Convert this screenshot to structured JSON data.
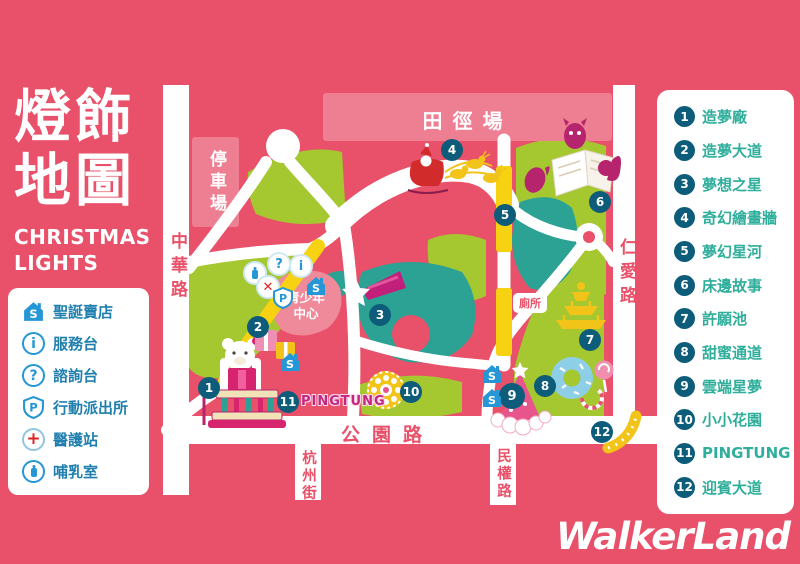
{
  "header": {
    "title_line1": "燈飾",
    "title_line2": "地圖",
    "subtitle_line1": "CHRISTMAS",
    "subtitle_line2": "LIGHTS"
  },
  "legend": {
    "items": [
      {
        "icon": "christmas-shop-house-icon",
        "label": "聖誕賣店"
      },
      {
        "icon": "info-icon",
        "label": "服務台"
      },
      {
        "icon": "question-icon",
        "label": "諮詢台"
      },
      {
        "icon": "police-shield-icon",
        "label": "行動派出所"
      },
      {
        "icon": "medical-cross-icon",
        "label": "醫護站"
      },
      {
        "icon": "nursing-bottle-icon",
        "label": "哺乳室"
      }
    ]
  },
  "attractions": {
    "items": [
      {
        "num": "1",
        "label": "造夢廠"
      },
      {
        "num": "2",
        "label": "造夢大道"
      },
      {
        "num": "3",
        "label": "夢想之星"
      },
      {
        "num": "4",
        "label": "奇幻繪畫牆"
      },
      {
        "num": "5",
        "label": "夢幻星河"
      },
      {
        "num": "6",
        "label": "床邊故事"
      },
      {
        "num": "7",
        "label": "許願池"
      },
      {
        "num": "8",
        "label": "甜蜜通道"
      },
      {
        "num": "9",
        "label": "雲端星夢"
      },
      {
        "num": "10",
        "label": "小小花園"
      },
      {
        "num": "11",
        "label": "PINGTUNG"
      },
      {
        "num": "12",
        "label": "迎賓大道"
      }
    ]
  },
  "map": {
    "areas": {
      "athletics_field": "田徑場",
      "parking_lot": "停車場",
      "youth_center_line1": "青少年",
      "youth_center_line2": "中心",
      "toilet": "廁所",
      "pingtung_sign": "PINGTUNG"
    },
    "roads": {
      "zhonghua": "中華路",
      "renai": "仁愛路",
      "gongyuan": "公園路",
      "hangzhou": "杭州街",
      "minquan": "民權路"
    },
    "icons": [
      "christmas-shop-house-icon",
      "question-icon",
      "info-icon",
      "nursing-bottle-icon",
      "medical-cross-icon",
      "police-shield-icon"
    ]
  },
  "footer": {
    "logo": "WalkerLand"
  },
  "colors": {
    "background_pink": "#e85169",
    "light_pink_area": "#ee7e91",
    "green_area": "#a5c72f",
    "pond_teal": "#2ba294",
    "marker_navy": "#0d5c7a",
    "legend_blue": "#1f7fae",
    "list_green": "#2fae9b",
    "magenta": "#c2267e",
    "road_yellow": "#f6d213"
  }
}
